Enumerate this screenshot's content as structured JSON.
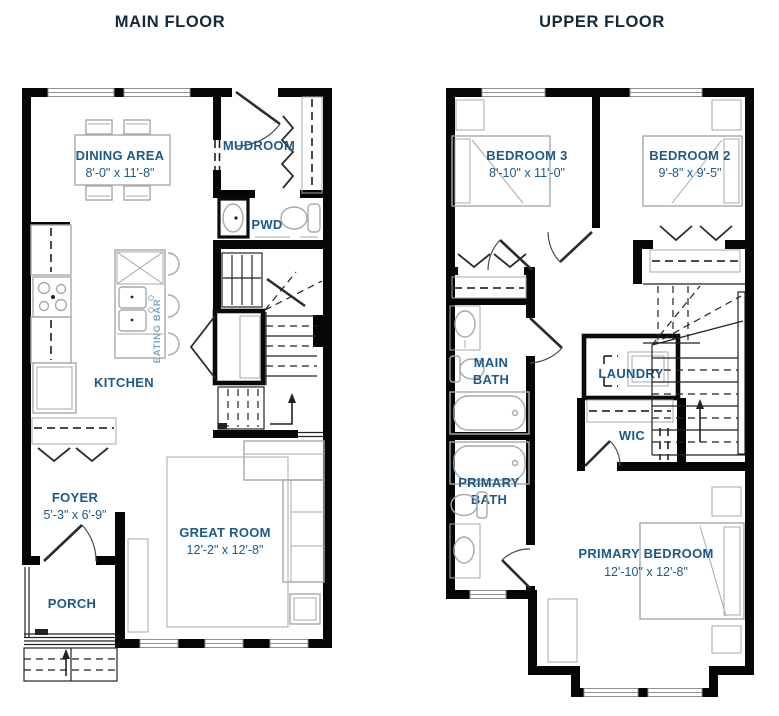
{
  "main_floor": {
    "title": "MAIN FLOOR",
    "rooms": {
      "dining": {
        "name": "DINING AREA",
        "dims": "8'-0\" x 11'-8\""
      },
      "mudroom": {
        "name": "MUDROOM"
      },
      "pwd": {
        "name": "PWD"
      },
      "kitchen": {
        "name": "KITCHEN"
      },
      "eating_bar": {
        "name": "EATING BAR"
      },
      "foyer": {
        "name": "FOYER",
        "dims": "5'-3\" x 6'-9\""
      },
      "porch": {
        "name": "PORCH"
      },
      "great_room": {
        "name": "GREAT ROOM",
        "dims": "12'-2\" x 12'-8\""
      }
    }
  },
  "upper_floor": {
    "title": "UPPER FLOOR",
    "rooms": {
      "bedroom3": {
        "name": "BEDROOM 3",
        "dims": "8'-10\" x 11'-0\""
      },
      "bedroom2": {
        "name": "BEDROOM 2",
        "dims": "9'-8\" x 9'-5\""
      },
      "main_bath": {
        "line1": "MAIN",
        "line2": "BATH"
      },
      "laundry": {
        "name": "LAUNDRY"
      },
      "wic": {
        "name": "WIC"
      },
      "primary_bath": {
        "line1": "PRIMARY",
        "line2": "BATH"
      },
      "primary_bedroom": {
        "name": "PRIMARY BEDROOM",
        "dims": "12'-10\" x 12'-8\""
      }
    }
  },
  "colors": {
    "wall": "#060606",
    "furniture": "#a7a9ac",
    "room_label": "#1b5a8a",
    "title": "#16293a",
    "eating_bar_label": "#7ea6c6"
  }
}
